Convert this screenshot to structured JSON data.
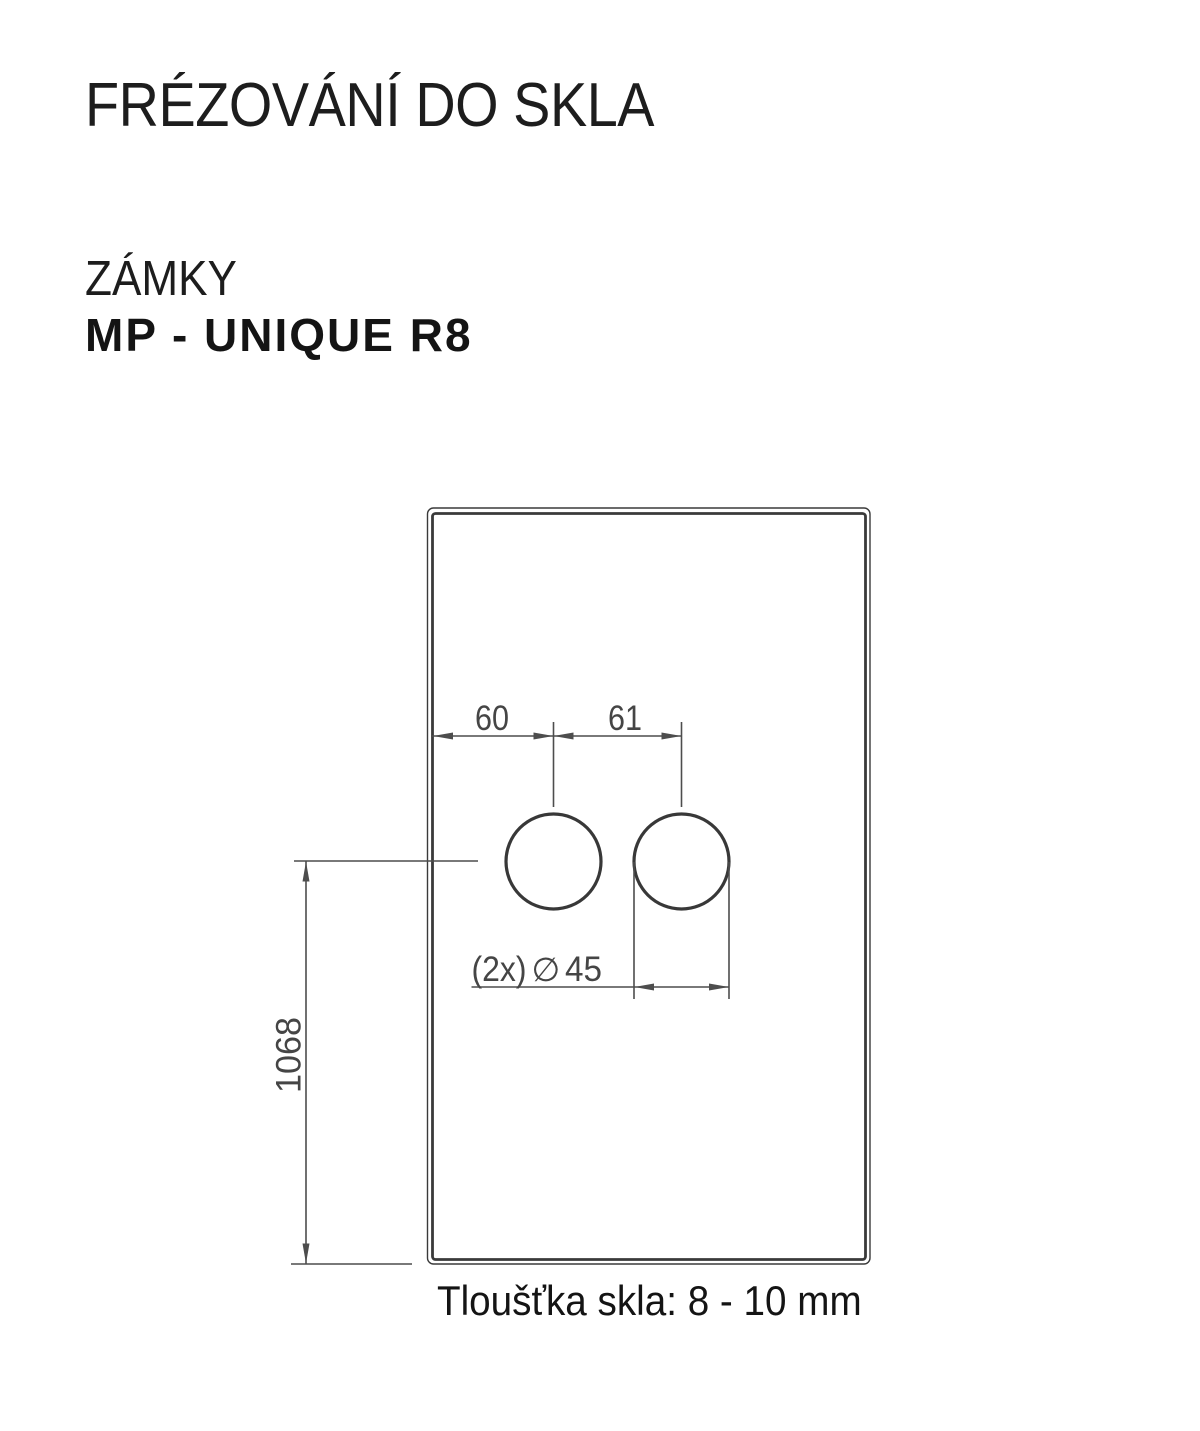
{
  "header": {
    "title": "FRÉZOVÁNÍ DO SKLA",
    "category": "ZÁMKY",
    "product": "MP - UNIQUE R8"
  },
  "drawing": {
    "dim_left_offset": "60",
    "dim_hole_spacing": "61",
    "dim_center_to_bottom": "1068",
    "hole_label_prefix": "(2x)",
    "hole_label_symbol": "∅",
    "hole_label_value": "45"
  },
  "dimensions": {
    "hole_offset_from_edge_mm": 60,
    "hole_center_spacing_mm": 61,
    "hole_center_to_bottom_mm": 1068,
    "hole_diameter_mm": 45,
    "hole_count": 2
  },
  "footer": {
    "note": "Tloušťka skla: 8 - 10 mm"
  },
  "colors": {
    "ink": "#1d1d1d",
    "glass_line": "#3a3a3a",
    "dim_line": "#4d4d4d",
    "dim_text": "#454545",
    "background": "#ffffff"
  }
}
